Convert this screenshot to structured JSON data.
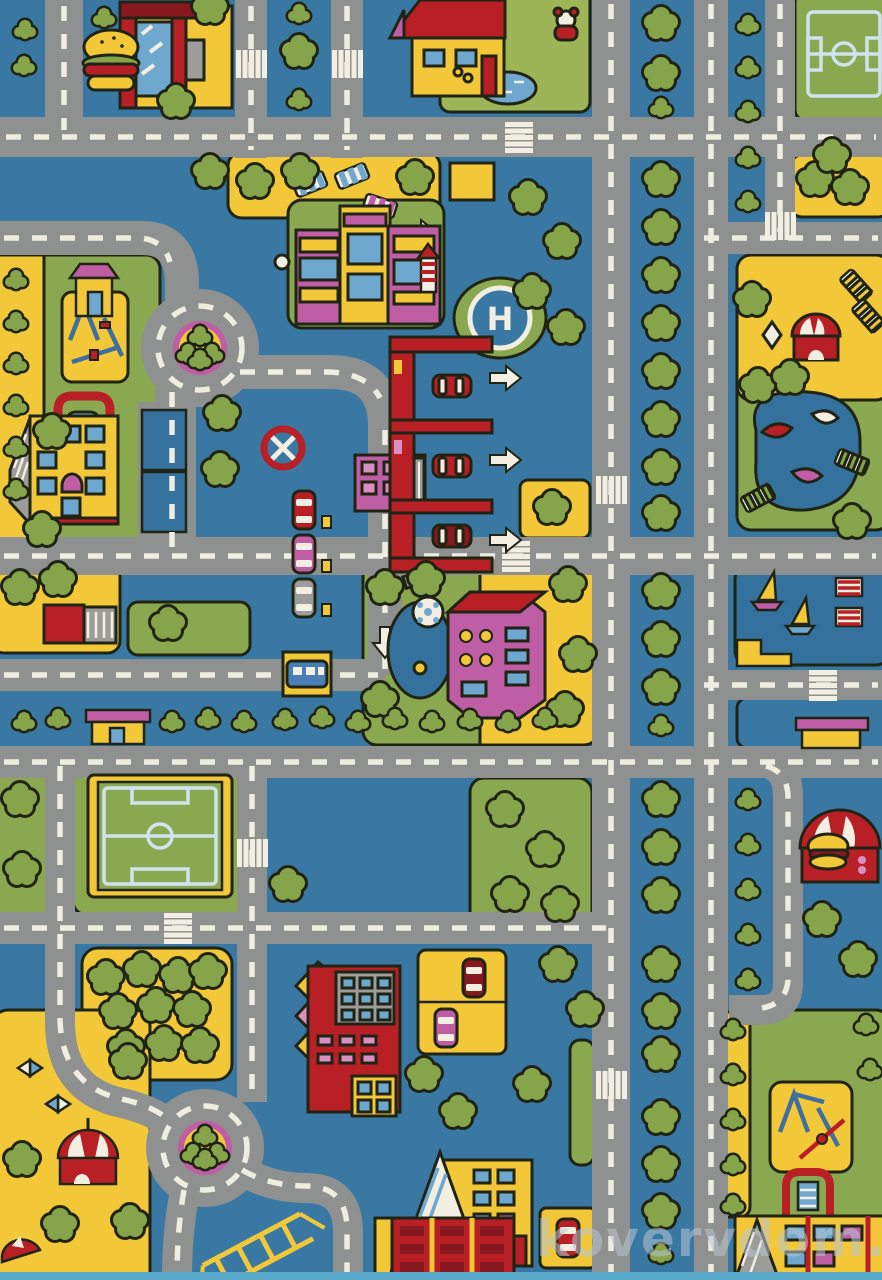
{
  "watermark": {
    "text": "kovervdom.ru"
  },
  "helipad": {
    "letter": "H"
  },
  "colors": {
    "bg": "#3a78a4",
    "pond": "#34719d",
    "road": "#8f9190",
    "dash": "#efece0",
    "yellow": "#f2c838",
    "grass": "#8aa850",
    "grass2": "#9db457",
    "tree": "#86a44a",
    "dark": "#202414",
    "red": "#b92025",
    "darkred": "#871820",
    "magenta": "#bf5ea4",
    "pink": "#d98fc0",
    "white": "#f2efe2",
    "glass": "#6fa8cf",
    "fieldline": "#cfe3ee",
    "gray": "#9c9d9b",
    "edge": "#57a8c9",
    "wm": "#b9c6d2"
  },
  "scene": {
    "objects": [
      "road-icon",
      "crosswalk-icon",
      "roundabout-icon",
      "tree-icon",
      "bush-icon",
      "burger-restaurant-icon",
      "house-icon",
      "soccer-field-icon",
      "helipad-icon",
      "lighthouse-icon",
      "parking-garage-icon",
      "no-entry-sign-icon",
      "fuel-station-icon",
      "school-icon",
      "playground-icon",
      "swing-icon",
      "apartment-building-icon",
      "orchard-icon",
      "carousel-tent-icon",
      "circus-kiosk-icon",
      "burger-stand-icon",
      "marina-boats-icon",
      "park-pond-icon",
      "slide-icon",
      "jungle-gym-icon",
      "car-icon",
      "bus-icon",
      "arrow-marking-icon"
    ]
  }
}
